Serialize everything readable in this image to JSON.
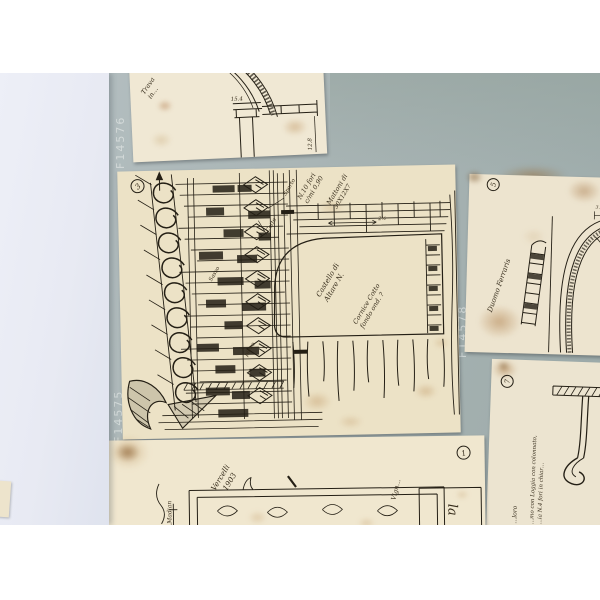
{
  "scene": {
    "description": "Photograph of five hand-drawn architectural sketch sheets mounted on a blue-grey archive board, partly covered by tissue paper at left",
    "colors": {
      "photo_border": "#ffffff",
      "board": "#a9b5b5",
      "tissue": "#e9ebf3",
      "paper": "#ece3c8",
      "ink": "#241f15",
      "stain": "#b98a54",
      "board_label": "#d8dedd"
    }
  },
  "labels": {
    "f14576": "F14576",
    "f14575": "F14575",
    "f14578": "F14578"
  },
  "sheets": {
    "top": {
      "note1": "Trava",
      "note2": "in…",
      "dim_top": "15.4",
      "dim_right": "12.8"
    },
    "main": {
      "num": "3",
      "n1": "N.10 fori",
      "n2": "c/mi 0,90",
      "n3": "Mattoni di",
      "n4": "30X12X7",
      "c1": "Castello di",
      "c2": "Altare N.",
      "c3": "Cornice Cotto",
      "c4": "fondo ond. ?",
      "l1": "Sporto",
      "l2": "Cotto",
      "l3": "Sasso",
      "l4": "pieno",
      "dim": "2½"
    },
    "right": {
      "num": "5",
      "note": "Duomo Ferraris",
      "dim": "3.8"
    },
    "bottom_right": {
      "num": "7",
      "v1": "…mo con Loggia con colonnato,",
      "v2": "…ia N.4 fori in chiar…",
      "v3": "…loro"
    },
    "bottom_center": {
      "num": "1",
      "d1": "Vercelli",
      "d2": "1903",
      "left_note": "…Madian",
      "right_note": "Vign…",
      "printed": "la"
    }
  }
}
